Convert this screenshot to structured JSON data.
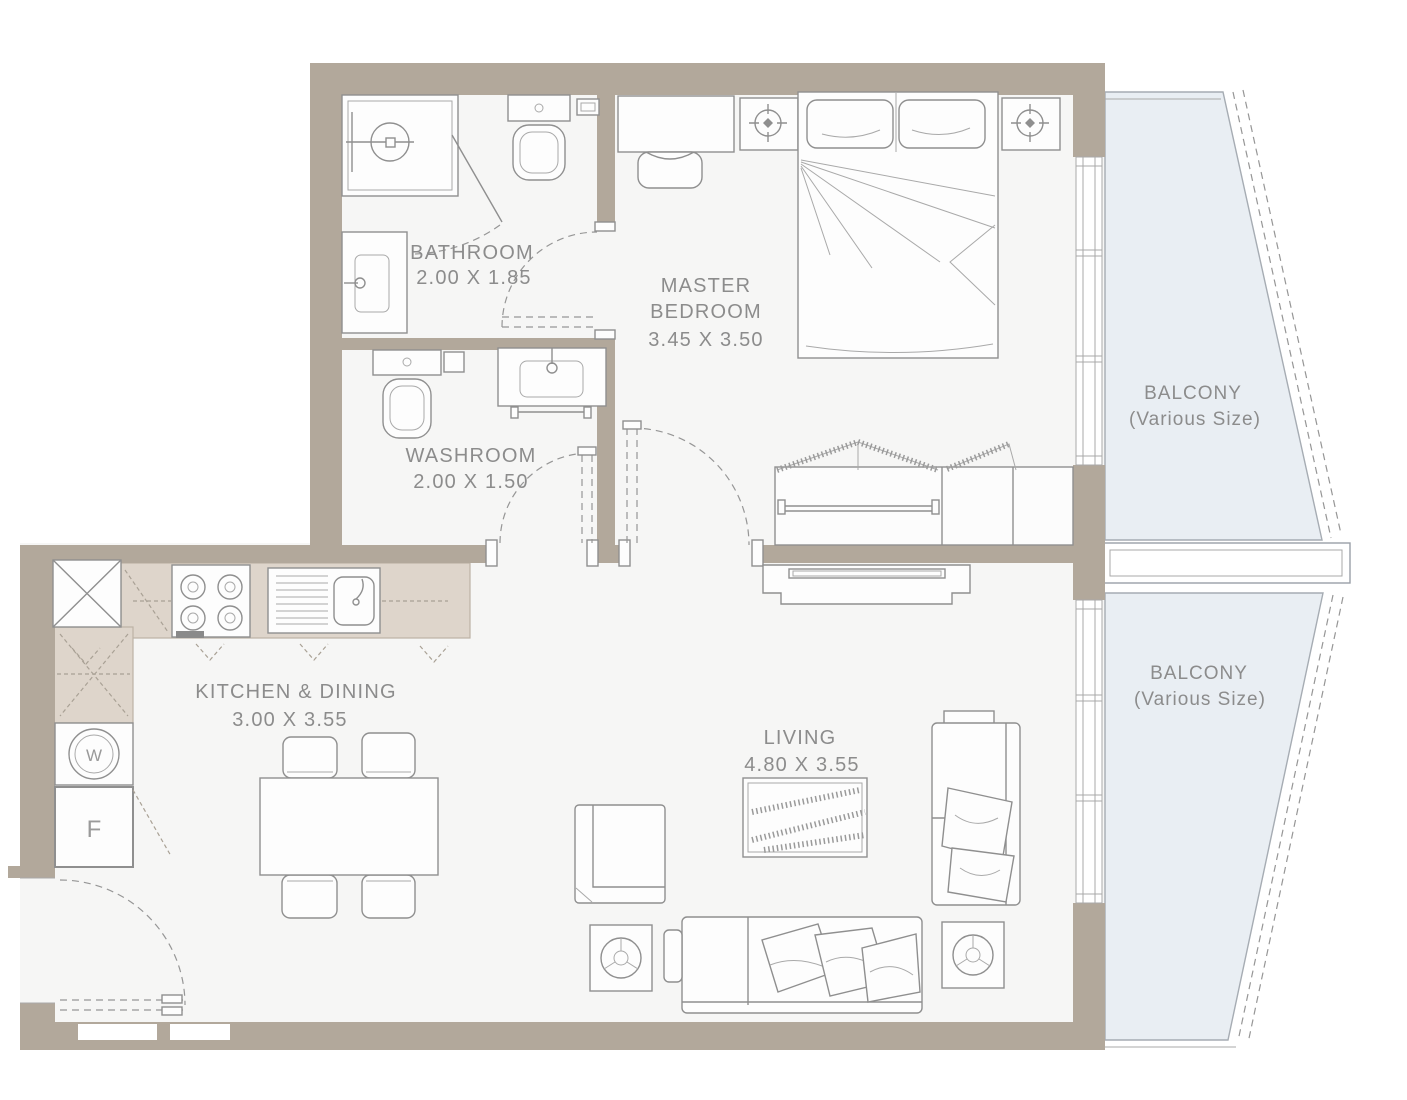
{
  "plan": {
    "rooms": {
      "bathroom": {
        "name": "BATHROOM",
        "dims": "2.00 X 1.85"
      },
      "washroom": {
        "name": "WASHROOM",
        "dims": "2.00 X 1.50"
      },
      "master_bedroom": {
        "name_line1": "MASTER",
        "name_line2": "BEDROOM",
        "dims": "3.45 X 3.50"
      },
      "kitchen_dining": {
        "name": "KITCHEN & DINING",
        "dims": "3.00 X 3.55"
      },
      "living": {
        "name": "LIVING",
        "dims": "4.80 X 3.55"
      },
      "balcony_top": {
        "name": "BALCONY",
        "note": "(Various Size)"
      },
      "balcony_bottom": {
        "name": "BALCONY",
        "note": "(Various Size)"
      }
    },
    "appliances": {
      "washer": "W",
      "fridge": "F"
    },
    "colors": {
      "wall": "#b2a89b",
      "kitchen_counter": "#ded5cb",
      "balcony_fill": "#e9eef3",
      "floor": "#f6f6f5",
      "line": "#8f8f8f",
      "text": "#8c8c8c"
    }
  }
}
